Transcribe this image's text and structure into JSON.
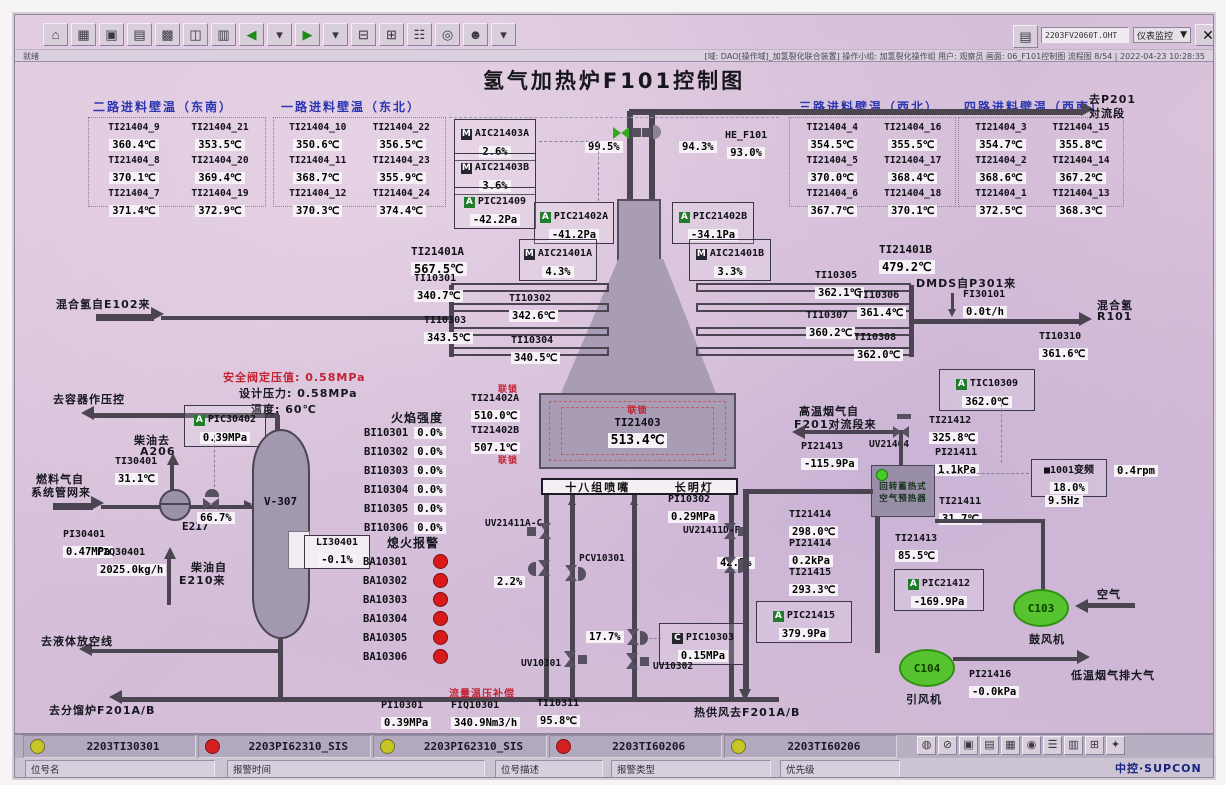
{
  "window": {
    "file_box": "2203FV2060T.OHT",
    "panel_combo": "仪表监控",
    "combo_arrow": "▼",
    "close": "✕",
    "status_left": "就绪",
    "status_right": "[域: DAO[操作域]_加氢裂化联合装置]  操作小组: 加氢裂化操作组  用户: 观察员  画面: 06_F101控制图  流程图 8/54 | 2022-04-23 10:28:35",
    "toolbar": [
      {
        "name": "toolbar-home",
        "g": "⌂"
      },
      {
        "name": "toolbar-overview",
        "g": "▦"
      },
      {
        "name": "toolbar-window",
        "g": "▣"
      },
      {
        "name": "toolbar-trend",
        "g": "▤"
      },
      {
        "name": "toolbar-group-display",
        "g": "▩"
      },
      {
        "name": "toolbar-faceplate",
        "g": "◫"
      },
      {
        "name": "toolbar-report",
        "g": "▥"
      },
      {
        "name": "toolbar-back",
        "g": "◀",
        "cls": "green"
      },
      {
        "name": "toolbar-back-menu",
        "g": "▾"
      },
      {
        "name": "toolbar-forward",
        "g": "▶",
        "cls": "green"
      },
      {
        "name": "toolbar-forward-menu",
        "g": "▾"
      },
      {
        "name": "toolbar-page-prev",
        "g": "⊟"
      },
      {
        "name": "toolbar-page-next",
        "g": "⊞"
      },
      {
        "name": "toolbar-book",
        "g": "☷"
      },
      {
        "name": "toolbar-search",
        "g": "◎"
      },
      {
        "name": "toolbar-user",
        "g": "☻"
      },
      {
        "name": "toolbar-user-menu",
        "g": "▾"
      }
    ],
    "sysicons": [
      {
        "name": "sys-horn",
        "g": "◍"
      },
      {
        "name": "sys-lock",
        "g": "⊘"
      },
      {
        "name": "sys-screen",
        "g": "▣"
      },
      {
        "name": "sys-print",
        "g": "▤"
      },
      {
        "name": "sys-grid",
        "g": "▦"
      },
      {
        "name": "sys-alarm",
        "g": "◉"
      },
      {
        "name": "sys-list",
        "g": "☰"
      },
      {
        "name": "sys-report",
        "g": "▥"
      },
      {
        "name": "sys-tile",
        "g": "⊞"
      },
      {
        "name": "sys-misc",
        "g": "✦"
      }
    ]
  },
  "title": "氢气加热炉F101控制图",
  "wall_panels": [
    {
      "title": "二路进料壁温（东南）",
      "items": [
        {
          "tag": "TI21404_9",
          "value": "360.4℃"
        },
        {
          "tag": "TI21404_21",
          "value": "353.5℃"
        },
        {
          "tag": "TI21404_8",
          "value": "370.1℃"
        },
        {
          "tag": "TI21404_20",
          "value": "369.4℃"
        },
        {
          "tag": "TI21404_7",
          "value": "371.4℃"
        },
        {
          "tag": "TI21404_19",
          "value": "372.9℃"
        }
      ]
    },
    {
      "title": "一路进料壁温（东北）",
      "items": [
        {
          "tag": "TI21404_10",
          "value": "350.6℃"
        },
        {
          "tag": "TI21404_22",
          "value": "356.5℃"
        },
        {
          "tag": "TI21404_11",
          "value": "368.7℃"
        },
        {
          "tag": "TI21404_23",
          "value": "355.9℃"
        },
        {
          "tag": "TI21404_12",
          "value": "370.3℃"
        },
        {
          "tag": "TI21404_24",
          "value": "374.4℃"
        }
      ]
    },
    {
      "title": "三路进料壁温（西北）",
      "items": [
        {
          "tag": "TI21404_4",
          "value": "354.5℃"
        },
        {
          "tag": "TI21404_16",
          "value": "355.5℃"
        },
        {
          "tag": "TI21404_5",
          "value": "370.0℃"
        },
        {
          "tag": "TI21404_17",
          "value": "368.4℃"
        },
        {
          "tag": "TI21404_6",
          "value": "367.7℃"
        },
        {
          "tag": "TI21404_18",
          "value": "370.1℃"
        }
      ]
    },
    {
      "title": "四路进料壁温（西南）",
      "items": [
        {
          "tag": "TI21404_3",
          "value": "354.7℃"
        },
        {
          "tag": "TI21404_15",
          "value": "355.8℃"
        },
        {
          "tag": "TI21404_2",
          "value": "368.6℃"
        },
        {
          "tag": "TI21404_14",
          "value": "367.2℃"
        },
        {
          "tag": "TI21404_1",
          "value": "372.5℃"
        },
        {
          "tag": "TI21404_13",
          "value": "368.3℃"
        }
      ]
    }
  ],
  "inst": {
    "aic21403a": {
      "p": "M",
      "tag": "AIC21403A",
      "value": "2.6%"
    },
    "aic21403b": {
      "p": "M",
      "tag": "AIC21403B",
      "value": "3.6%"
    },
    "pic21409": {
      "p": "A",
      "tag": "PIC21409",
      "value": "-42.2Pa"
    },
    "pic21402a": {
      "p": "A",
      "tag": "PIC21402A",
      "value": "-41.2Pa"
    },
    "pic21402b": {
      "p": "A",
      "tag": "PIC21402B",
      "value": "-34.1Pa"
    },
    "aic21401a": {
      "p": "M",
      "tag": "AIC21401A",
      "value": "4.3%"
    },
    "aic21401b": {
      "p": "M",
      "tag": "AIC21401B",
      "value": "3.3%"
    },
    "he_f101": {
      "tag": "HE_F101",
      "value": "93.0%"
    },
    "v995": "99.5%",
    "v943": "94.3%",
    "v667": "66.7%",
    "v22": "2.2%",
    "v422": "42.2%",
    "v177": "17.7%",
    "ti21401a": {
      "tag": "TI21401A",
      "value": "567.5℃"
    },
    "ti21401b": {
      "tag": "TI21401B",
      "value": "479.2℃"
    },
    "ti10301": {
      "tag": "TI10301",
      "value": "340.7℃"
    },
    "ti10302": {
      "tag": "TI10302",
      "value": "342.6℃"
    },
    "ti10303": {
      "tag": "TI10303",
      "value": "343.5℃"
    },
    "ti10304": {
      "tag": "TI10304",
      "value": "340.5℃"
    },
    "ti10305": {
      "tag": "TI10305",
      "value": "362.1℃"
    },
    "ti10306": {
      "tag": "TI10306",
      "value": "361.4℃"
    },
    "ti10307": {
      "tag": "TI10307",
      "value": "360.2℃"
    },
    "ti10308": {
      "tag": "TI10308",
      "value": "362.0℃"
    },
    "fi30101": {
      "tag": "FI30101",
      "value": "0.0t/h"
    },
    "ti10310": {
      "tag": "TI10310",
      "value": "361.6℃"
    },
    "tic10309": {
      "p": "A",
      "tag": "TIC10309",
      "value": "362.0℃"
    },
    "ti21402a": {
      "tag": "TI21402A",
      "value": "510.0℃"
    },
    "ti21402b": {
      "tag": "TI21402B",
      "value": "507.1℃"
    },
    "ti21403": {
      "tag": "TI21403",
      "value": "513.4℃"
    },
    "pi10302": {
      "tag": "PI10302",
      "value": "0.29MPa"
    },
    "pic30402": {
      "p": "A",
      "tag": "PIC30402",
      "value": "0.39MPa"
    },
    "ti30401": {
      "tag": "TI30401",
      "value": "31.1℃"
    },
    "pi30401": {
      "tag": "PI30401",
      "value": "0.47MPa"
    },
    "fiq30401": {
      "tag": "FIQ30401",
      "value": "2025.0kg/h"
    },
    "li30401": {
      "tag": "LI30401",
      "value": "-0.1%"
    },
    "pic10303": {
      "p": "C",
      "tag": "PIC10303",
      "value": "0.15MPa"
    },
    "pi10301": {
      "tag": "PI10301",
      "value": "0.39MPa"
    },
    "fiq10301": {
      "tag": "FIQ10301",
      "value": "340.9Nm3/h"
    },
    "ti10311": {
      "tag": "TI10311",
      "value": "95.8℃"
    },
    "ti21412": {
      "tag": "TI21412",
      "value": "325.8℃"
    },
    "pi21413": {
      "tag": "PI21413",
      "value": "-115.9Pa"
    },
    "pi21411": {
      "tag": "PI21411",
      "value": "1.1kPa"
    },
    "freq1001": {
      "tag": "■1001变频",
      "value": "18.0%",
      "extra": "9.5Hz"
    },
    "rpm": "0.4rpm",
    "ti21411": {
      "tag": "TI21411",
      "value": "31.7℃"
    },
    "ti21414": {
      "tag": "TI21414",
      "value": "298.0℃"
    },
    "pi21414": {
      "tag": "PI21414",
      "value": "0.2kPa"
    },
    "ti21415": {
      "tag": "TI21415",
      "value": "293.3℃"
    },
    "ti21413": {
      "tag": "TI21413",
      "value": "85.5℃"
    },
    "pic21412": {
      "p": "A",
      "tag": "PIC21412",
      "value": "-169.9Pa"
    },
    "pic21415": {
      "p": "A",
      "tag": "PIC21415",
      "value": "379.9Pa"
    },
    "pi21416": {
      "tag": "PI21416",
      "value": "-0.0kPa"
    }
  },
  "flame": {
    "title": "火焰强度",
    "items": [
      {
        "tag": "BI10301",
        "value": "0.0%"
      },
      {
        "tag": "BI10302",
        "value": "0.0%"
      },
      {
        "tag": "BI10303",
        "value": "0.0%"
      },
      {
        "tag": "BI10304",
        "value": "0.0%"
      },
      {
        "tag": "BI10305",
        "value": "0.0%"
      },
      {
        "tag": "BI10306",
        "value": "0.0%"
      }
    ]
  },
  "flameout": {
    "title": "熄火报警",
    "items": [
      {
        "tag": "BA10301"
      },
      {
        "tag": "BA10302"
      },
      {
        "tag": "BA10303"
      },
      {
        "tag": "BA10304"
      },
      {
        "tag": "BA10305"
      },
      {
        "tag": "BA10306"
      }
    ]
  },
  "labels": {
    "to_p201_1": "去P201",
    "to_p201_2": "对流段",
    "mix_h2_in": "混合氢自E102来",
    "dmds": "DMDS自P301来",
    "mix_h2": "混合氢",
    "r101": "R101",
    "to_vessel": "去容器作压控",
    "safety": "安全阀定压值: 0.58MPa",
    "design": "设计压力: 0.58MPa",
    "temp": "温度: 60℃",
    "diesel_to": "柴油去",
    "a206": "A206",
    "fuel_gas1": "燃料气自",
    "fuel_gas2": "系统管网来",
    "diesel_from1": "柴油自",
    "diesel_from2": "E210来",
    "to_liquid": "去液体放空线",
    "to_frac": "去分馏炉F201A/B",
    "e217": "E217",
    "v307": "V-307",
    "interlock": "联锁",
    "burner18": "十八组喷嘴",
    "pilot": "长明灯",
    "flow_comp": "流量温压补偿",
    "hot_air": "热供风去F201A/B",
    "hot_flue1": "高温烟气自",
    "hot_flue2": "F201对流段来",
    "uv21404": "UV21404",
    "uv21411ac": "UV21411A-C",
    "uv21411df": "UV21411D-F",
    "pcv10301": "PCV10301",
    "uv10301": "UV10301",
    "uv10302": "UV10302",
    "preheater1": "回转蓄热式",
    "preheater2": "空气预热器",
    "air": "空气",
    "blower": "鼓风机",
    "inducer": "引风机",
    "c103": "C103",
    "c104": "C104",
    "low_flue": "低温烟气排大气"
  },
  "alarm_bar": {
    "cells": [
      {
        "color": "yellow",
        "tag": "2203TI30301"
      },
      {
        "color": "red",
        "tag": "2203PI62310_SIS"
      },
      {
        "color": "yellow",
        "tag": "2203PI62310_SIS"
      },
      {
        "color": "red",
        "tag": "2203TI60206"
      },
      {
        "color": "yellow",
        "tag": "2203TI60206"
      }
    ],
    "fields": [
      "位号名",
      "报警时间",
      "位号描述",
      "报警类型",
      "优先级"
    ],
    "logo": "中控·SUPCON"
  }
}
